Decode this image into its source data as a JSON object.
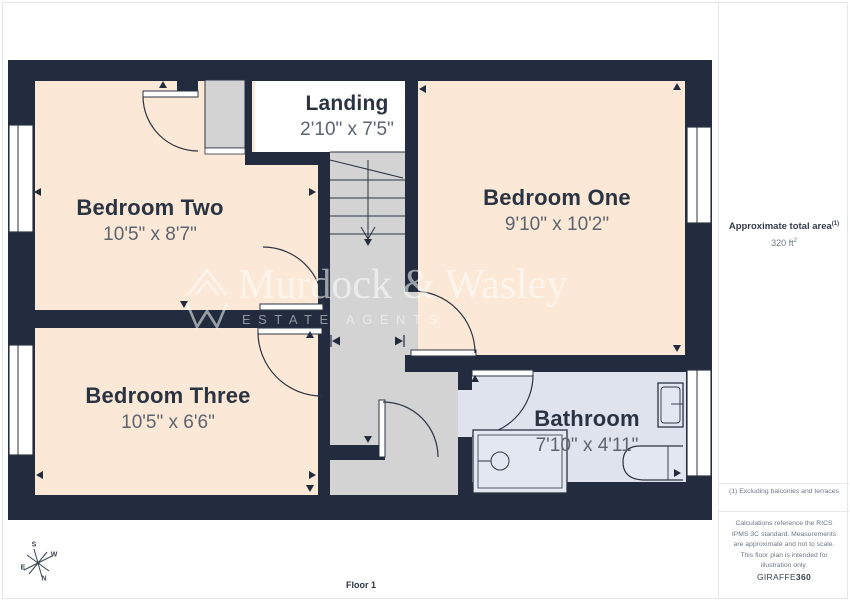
{
  "rooms": [
    {
      "name": "Bedroom Two",
      "dims": "10'5\" x 8'7\""
    },
    {
      "name": "Bedroom One",
      "dims": "9'10\" x 10'2\""
    },
    {
      "name": "Bedroom Three",
      "dims": "10'5\" x 6'6\""
    },
    {
      "name": "Landing",
      "dims": "2'10\" x 7'5\""
    },
    {
      "name": "Bathroom",
      "dims": "7'10\" x 4'11\""
    }
  ],
  "watermark": {
    "name": "Murdock & Wasley",
    "tagline": "ESTATE AGENTS",
    "logo_icon": "mountain-w-chevrons"
  },
  "sidebar": {
    "area_label": "Approximate total area",
    "area_label_sup": "(1)",
    "area_value": "320 ft",
    "area_value_sup": "2",
    "footnote": "(1) Excluding balconies and terraces",
    "disclaimer": "Calculations reference the RICS IPMS 3C standard. Measurements are approximate and not to scale. This floor plan is intended for illustration only.",
    "brand_normal": "GIRAFFE",
    "brand_bold": "360"
  },
  "footer": {
    "floor_label": "Floor 1"
  },
  "compass": {
    "s": "S",
    "w": "W",
    "e": "E",
    "n": "N"
  },
  "colors": {
    "wall": "#232c3e",
    "room_floor": "#fbe8d6",
    "corridor_floor": "#d3d3d3",
    "bathroom_floor": "#dfe3ed",
    "window": "#ffffff",
    "label_text": "#2a3342",
    "dims_text": "#5d6470"
  }
}
